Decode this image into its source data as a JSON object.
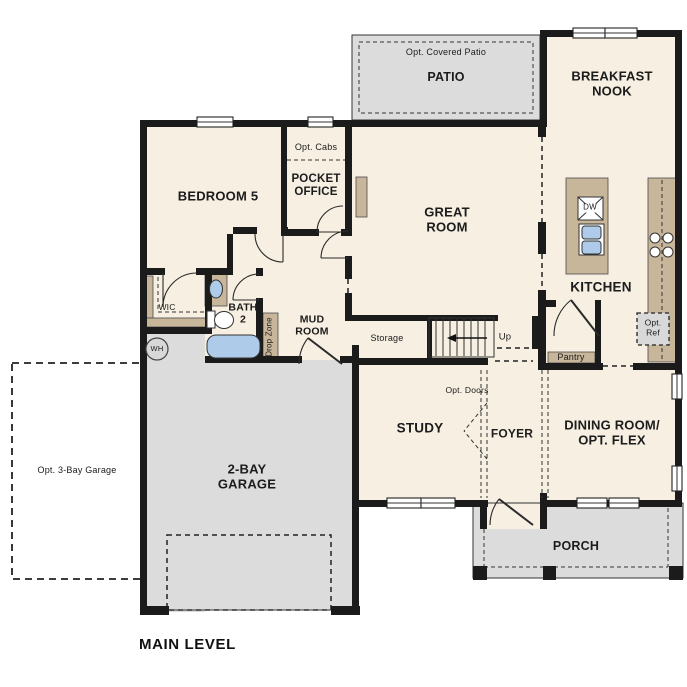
{
  "title": "MAIN LEVEL",
  "colors": {
    "room_fill": "#f6efe2",
    "outdoor_fill": "#dcdcdc",
    "cabinet_fill": "#c8b69b",
    "fixture_fill": "#aecbea",
    "wall": "#1b1b1b"
  },
  "rooms": {
    "patio": "PATIO",
    "opt_covered_patio": "Opt. Covered Patio",
    "breakfast_nook": "BREAKFAST NOOK",
    "bedroom5": "BEDROOM 5",
    "pocket_office": "POCKET OFFICE",
    "opt_cabs": "Opt. Cabs",
    "great_room": "GREAT ROOM",
    "kitchen": "KITCHEN",
    "pantry": "Pantry",
    "opt_ref": "Opt. Ref",
    "wic": "WIC",
    "bath2": "BATH 2",
    "mud_room": "MUD ROOM",
    "drop_zone": "Drop Zone",
    "storage": "Storage",
    "stairs_up": "Up",
    "study": "STUDY",
    "opt_doors": "Opt. Doors",
    "foyer": "FOYER",
    "dining_room": "DINING ROOM/ OPT. FLEX",
    "garage": "2-BAY GARAGE",
    "opt_garage": "Opt. 3-Bay Garage",
    "porch": "PORCH"
  },
  "fixtures": {
    "water_heater": "WH",
    "dishwasher": "DW"
  }
}
